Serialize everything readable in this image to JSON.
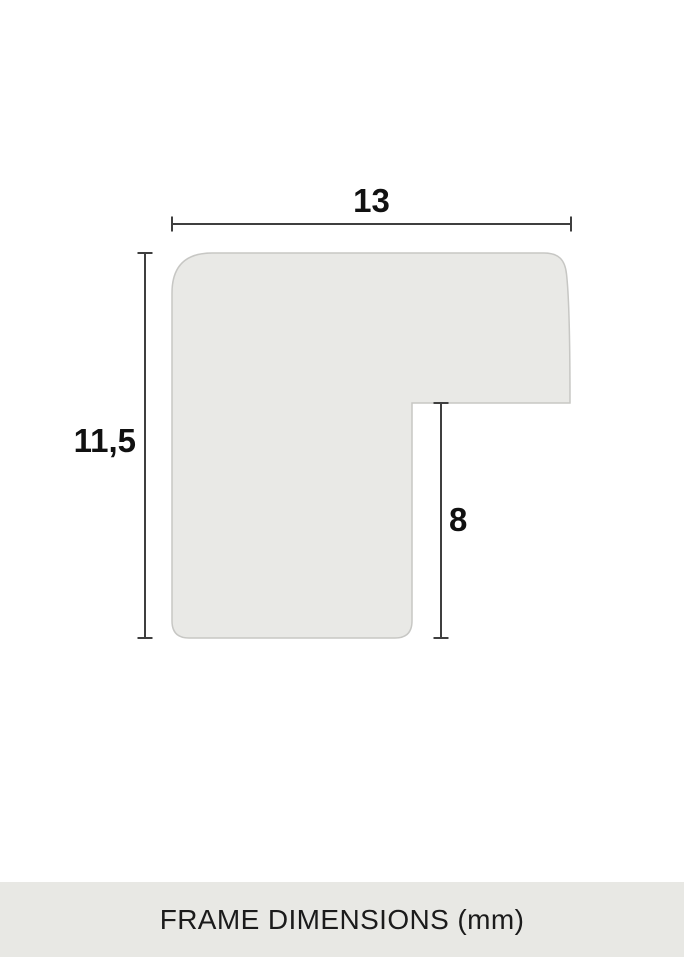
{
  "diagram": {
    "name": "frame-profile-cross-section",
    "shape_fill": "#e9e9e6",
    "shape_stroke": "#c7c7c4",
    "dimension_line_color": "#3f3f3f",
    "label_color": "#111111",
    "dimensions": {
      "width_label": "13",
      "height_label": "11,5",
      "notch_label": "8"
    }
  },
  "footer": {
    "label": "FRAME DIMENSIONS (mm)",
    "background": "#e8e8e4",
    "text_color": "#1b1b1b"
  }
}
